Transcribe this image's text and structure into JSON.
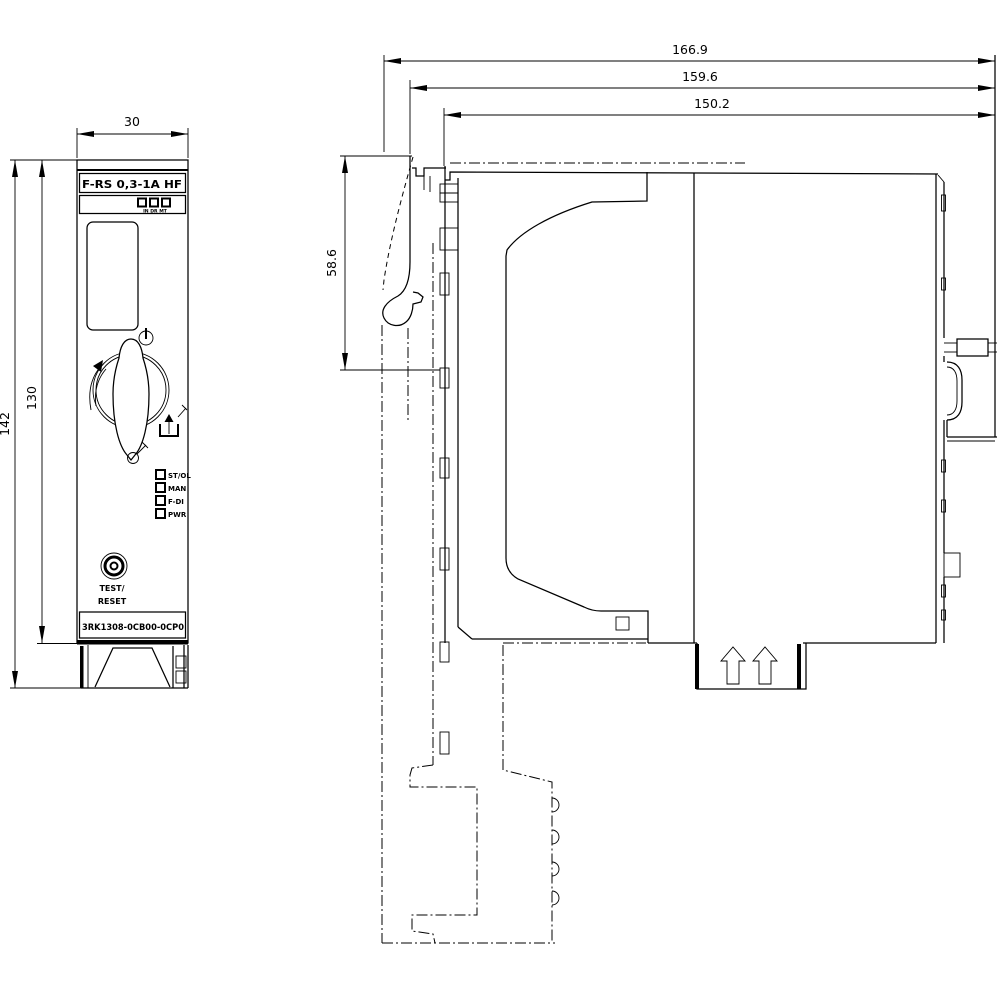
{
  "front_view": {
    "width_dim": "30",
    "total_height_dim": "142",
    "body_height_dim": "130",
    "product_label": "F-RS  0,3-1A  HF",
    "switch_positions_label": "IN DR MT",
    "leds": [
      "ST/OL",
      "MAN",
      "F-DI",
      "PWR"
    ],
    "button_label_top": "TEST/",
    "button_label_bottom": "RESET",
    "part_number": "3RK1308-0CB00-0CP0"
  },
  "side_view": {
    "overall_depth_dim": "166.9",
    "mid_depth_dim": "159.6",
    "body_depth_dim": "150.2",
    "top_height_dim": "58.6"
  },
  "colors": {
    "line": "#000000",
    "background": "#ffffff"
  }
}
